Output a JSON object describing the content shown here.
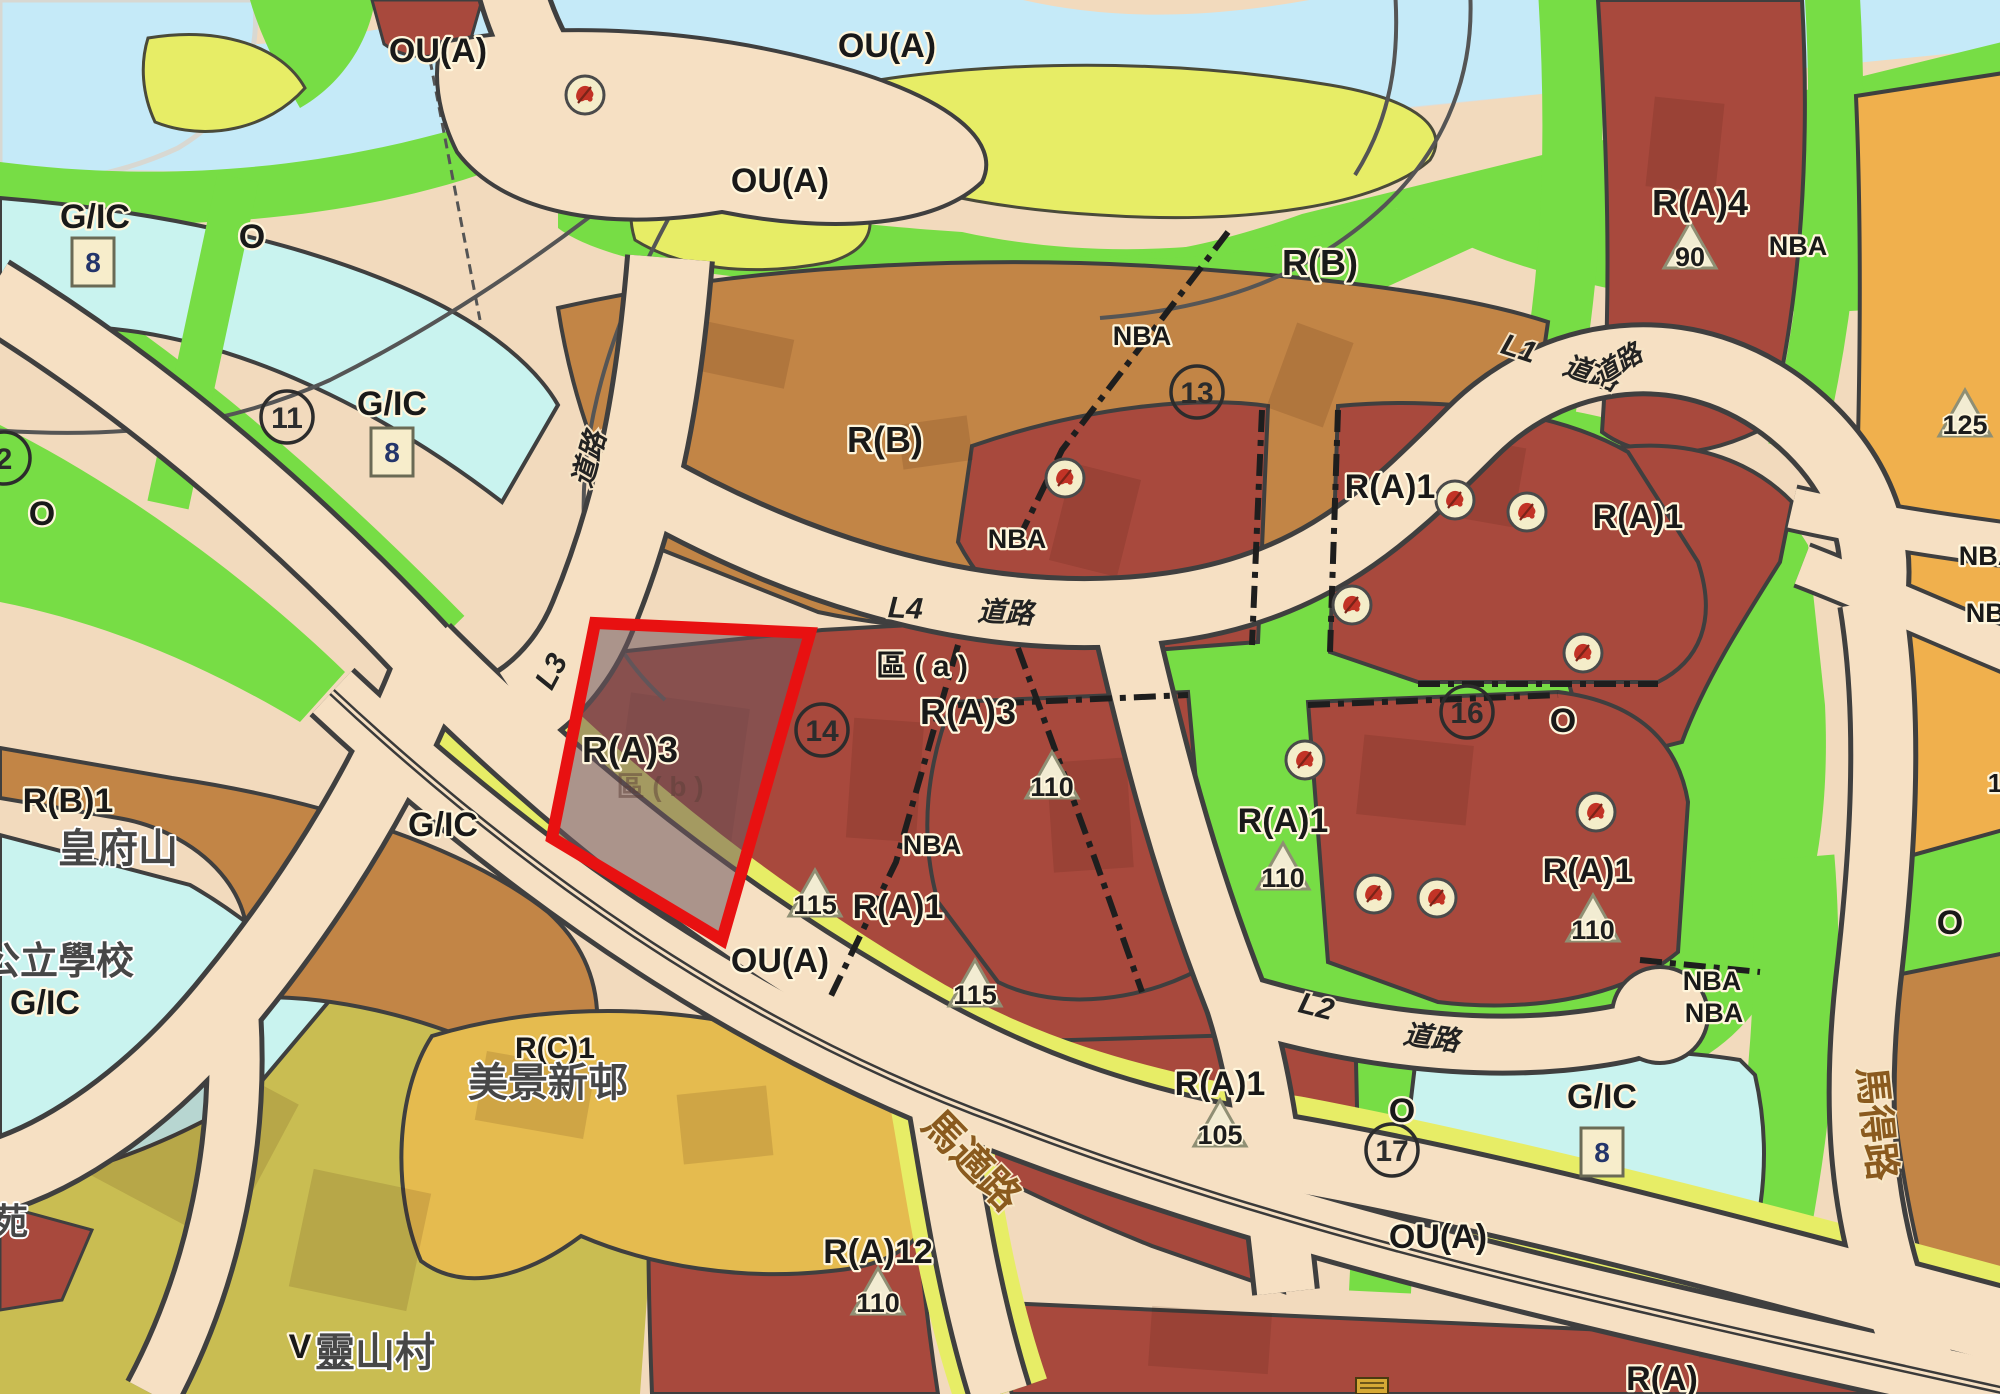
{
  "map_type": "statutory-outline-zoning-plan-extract",
  "colors": {
    "residential_a": "#a8493d",
    "residential_b": "#c28546",
    "residential_c": "#e5bb4f",
    "village": "#c9bd52",
    "gic_cyan": "#c9f3ef",
    "open_space_green": "#77dd45",
    "other_uses_yellow": "#e7ed66",
    "orange_zone": "#f0b04d",
    "road_beige": "#f6e0c3",
    "river_blue": "#c5eaf8",
    "site_highlight_red": "#e81111"
  },
  "zone_labels": [
    {
      "t": "OU(A)",
      "x": 438,
      "y": 62,
      "s": 34,
      "c": "std"
    },
    {
      "t": "OU(A)",
      "x": 887,
      "y": 57,
      "s": 34,
      "c": "std"
    },
    {
      "t": "OU(A)",
      "x": 780,
      "y": 192,
      "s": 34,
      "c": "std"
    },
    {
      "t": "G/IC",
      "x": 95,
      "y": 228,
      "s": 34,
      "c": "std"
    },
    {
      "t": "O",
      "x": 252,
      "y": 248,
      "s": 34,
      "c": "std"
    },
    {
      "t": "G/IC",
      "x": 392,
      "y": 415,
      "s": 34,
      "c": "std"
    },
    {
      "t": "R(B)",
      "x": 1320,
      "y": 275,
      "s": 36,
      "c": "std"
    },
    {
      "t": "NBA",
      "x": 1142,
      "y": 345,
      "s": 27,
      "c": "std"
    },
    {
      "t": "R(A)4",
      "x": 1700,
      "y": 215,
      "s": 36,
      "c": "std"
    },
    {
      "t": "NBA",
      "x": 1798,
      "y": 255,
      "s": 27,
      "c": "std"
    },
    {
      "t": "R(B)",
      "x": 885,
      "y": 452,
      "s": 36,
      "c": "std"
    },
    {
      "t": "NBA",
      "x": 1017,
      "y": 548,
      "s": 27,
      "c": "std"
    },
    {
      "t": "O",
      "x": 42,
      "y": 525,
      "s": 34,
      "c": "std"
    },
    {
      "t": "R(A)1",
      "x": 1390,
      "y": 498,
      "s": 34,
      "c": "std"
    },
    {
      "t": "R(A)1",
      "x": 1638,
      "y": 528,
      "s": 34,
      "c": "std"
    },
    {
      "t": "區 ( a )",
      "x": 922,
      "y": 676,
      "s": 30,
      "c": "std"
    },
    {
      "t": "R(A)3",
      "x": 968,
      "y": 724,
      "s": 36,
      "c": "std"
    },
    {
      "t": "R(A)3",
      "x": 630,
      "y": 762,
      "s": 36,
      "c": "std"
    },
    {
      "t": "區 ( b )",
      "x": 660,
      "y": 796,
      "s": 28,
      "c": "faint"
    },
    {
      "t": "O",
      "x": 1563,
      "y": 732,
      "s": 34,
      "c": "std"
    },
    {
      "t": "NBA",
      "x": 932,
      "y": 854,
      "s": 27,
      "c": "std"
    },
    {
      "t": "R(A)1",
      "x": 898,
      "y": 918,
      "s": 34,
      "c": "std"
    },
    {
      "t": "G/IC",
      "x": 443,
      "y": 836,
      "s": 34,
      "c": "std"
    },
    {
      "t": "R(B)1",
      "x": 68,
      "y": 812,
      "s": 34,
      "c": "std"
    },
    {
      "t": "皇府山",
      "x": 118,
      "y": 862,
      "s": 40,
      "c": "cjk"
    },
    {
      "t": "OU(A)",
      "x": 780,
      "y": 972,
      "s": 34,
      "c": "std"
    },
    {
      "t": "R(A)1",
      "x": 1283,
      "y": 832,
      "s": 34,
      "c": "std"
    },
    {
      "t": "R(A)1",
      "x": 1588,
      "y": 882,
      "s": 34,
      "c": "std"
    },
    {
      "t": "公立學校",
      "x": 58,
      "y": 974,
      "s": 38,
      "c": "cjk"
    },
    {
      "t": "G/IC",
      "x": 45,
      "y": 1014,
      "s": 34,
      "c": "std"
    },
    {
      "t": "O",
      "x": 1950,
      "y": 934,
      "s": 34,
      "c": "std"
    },
    {
      "t": "NBA",
      "x": 1712,
      "y": 990,
      "s": 27,
      "c": "std"
    },
    {
      "t": "NBA",
      "x": 1714,
      "y": 1022,
      "s": 27,
      "c": "std"
    },
    {
      "t": "R(A)1",
      "x": 1220,
      "y": 1095,
      "s": 34,
      "c": "std"
    },
    {
      "t": "G/IC",
      "x": 1602,
      "y": 1108,
      "s": 34,
      "c": "std"
    },
    {
      "t": "OU(A)",
      "x": 1438,
      "y": 1248,
      "s": 34,
      "c": "std"
    },
    {
      "t": "R(C)1",
      "x": 555,
      "y": 1058,
      "s": 30,
      "c": "std"
    },
    {
      "t": "美景新邨",
      "x": 548,
      "y": 1096,
      "s": 40,
      "c": "cjk"
    },
    {
      "t": "V",
      "x": 300,
      "y": 1358,
      "s": 34,
      "c": "std"
    },
    {
      "t": "靈山村",
      "x": 375,
      "y": 1366,
      "s": 40,
      "c": "cjk"
    },
    {
      "t": "R(A)12",
      "x": 878,
      "y": 1263,
      "s": 34,
      "c": "std"
    },
    {
      "t": "R(A)",
      "x": 1662,
      "y": 1390,
      "s": 34,
      "c": "std"
    },
    {
      "t": "苑",
      "x": 10,
      "y": 1234,
      "s": 36,
      "c": "cjk"
    },
    {
      "t": "NBA",
      "x": 1988,
      "y": 565,
      "s": 27,
      "c": "std"
    },
    {
      "t": "NBA",
      "x": 1995,
      "y": 622,
      "s": 27,
      "c": "std"
    },
    {
      "t": "O",
      "x": 1402,
      "y": 1122,
      "s": 34,
      "c": "std"
    },
    {
      "t": "1",
      "x": 1995,
      "y": 792,
      "s": 26,
      "c": "std"
    }
  ],
  "road_labels": [
    {
      "t": "L1",
      "x": 1516,
      "y": 358,
      "s": 30,
      "c": "road",
      "r": 18
    },
    {
      "t": "道路",
      "x": 1588,
      "y": 382,
      "s": 28,
      "c": "road",
      "r": 18
    },
    {
      "t": "L4",
      "x": 905,
      "y": 618,
      "s": 30,
      "c": "road",
      "r": 3
    },
    {
      "t": "道路",
      "x": 1005,
      "y": 622,
      "s": 28,
      "c": "road",
      "r": 3
    },
    {
      "t": "L3",
      "x": 560,
      "y": 676,
      "s": 30,
      "c": "road",
      "r": -62
    },
    {
      "t": "道路",
      "x": 598,
      "y": 462,
      "s": 28,
      "c": "road",
      "r": -74
    },
    {
      "t": "L2",
      "x": 1314,
      "y": 1016,
      "s": 30,
      "c": "road",
      "r": 14
    },
    {
      "t": "道路",
      "x": 1430,
      "y": 1047,
      "s": 28,
      "c": "road",
      "r": 8
    },
    {
      "t": "道路",
      "x": 1622,
      "y": 372,
      "s": 26,
      "c": "road",
      "r": -32
    },
    {
      "t": "馬適路",
      "x": 962,
      "y": 1170,
      "s": 40,
      "c": "roadcjk",
      "r": 46
    },
    {
      "t": "馬得路",
      "x": 1864,
      "y": 1125,
      "s": 38,
      "c": "roadcjk",
      "r": 84
    }
  ],
  "circled_numbers": [
    {
      "n": "11",
      "x": 287,
      "y": 417
    },
    {
      "n": "2",
      "x": 4,
      "y": 458
    },
    {
      "n": "13",
      "x": 1197,
      "y": 392
    },
    {
      "n": "14",
      "x": 822,
      "y": 730
    },
    {
      "n": "16",
      "x": 1467,
      "y": 712
    },
    {
      "n": "17",
      "x": 1392,
      "y": 1150
    }
  ],
  "height_triangles": [
    {
      "v": "90",
      "x": 1690,
      "y": 252
    },
    {
      "v": "125",
      "x": 1965,
      "y": 420
    },
    {
      "v": "110",
      "x": 1052,
      "y": 782
    },
    {
      "v": "115",
      "x": 815,
      "y": 900
    },
    {
      "v": "115",
      "x": 975,
      "y": 990
    },
    {
      "v": "110",
      "x": 1283,
      "y": 873
    },
    {
      "v": "110",
      "x": 1593,
      "y": 925
    },
    {
      "v": "110",
      "x": 878,
      "y": 1298
    },
    {
      "v": "105",
      "x": 1220,
      "y": 1130
    }
  ],
  "gic_badges": [
    {
      "v": "8",
      "x": 93,
      "y": 262
    },
    {
      "v": "8",
      "x": 392,
      "y": 452
    },
    {
      "v": "8",
      "x": 1602,
      "y": 1152
    }
  ],
  "heritage_markers": [
    {
      "x": 585,
      "y": 95
    },
    {
      "x": 1065,
      "y": 478
    },
    {
      "x": 1455,
      "y": 500
    },
    {
      "x": 1527,
      "y": 512
    },
    {
      "x": 1352,
      "y": 605
    },
    {
      "x": 1583,
      "y": 653
    },
    {
      "x": 1305,
      "y": 760
    },
    {
      "x": 1374,
      "y": 894
    },
    {
      "x": 1437,
      "y": 898
    },
    {
      "x": 1596,
      "y": 812
    }
  ],
  "site_highlight": {
    "zone": "R(A)3",
    "sub_area": "區 ( b )",
    "outline_color": "#e81111"
  }
}
